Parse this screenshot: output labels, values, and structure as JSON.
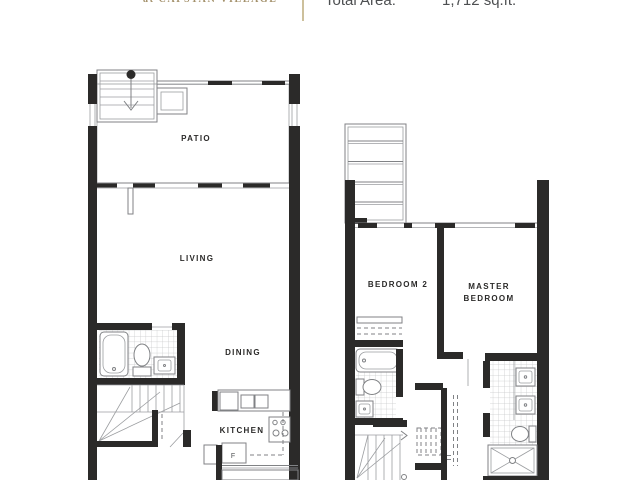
{
  "header": {
    "project_name": "at CAPSTAN VILLAGE",
    "total_area_label": "Total Area:",
    "total_area_value": "1,712 sq.ft."
  },
  "plans": {
    "main_floor": {
      "patio": "PATIO",
      "living": "LIVING",
      "dining": "DINING",
      "kitchen": "KITCHEN",
      "fridge": "F"
    },
    "upper_floor": {
      "bedroom2": "BEDROOM 2",
      "master_line1": "MASTER",
      "master_line2": "BEDROOM"
    }
  },
  "colors": {
    "wall": "#2b2a29",
    "line": "#808285",
    "tile_grid": "#c6c7c9",
    "accent_gold": "#cdc09c",
    "header_text": "#4d4f51",
    "project_text": "#a3906a"
  }
}
